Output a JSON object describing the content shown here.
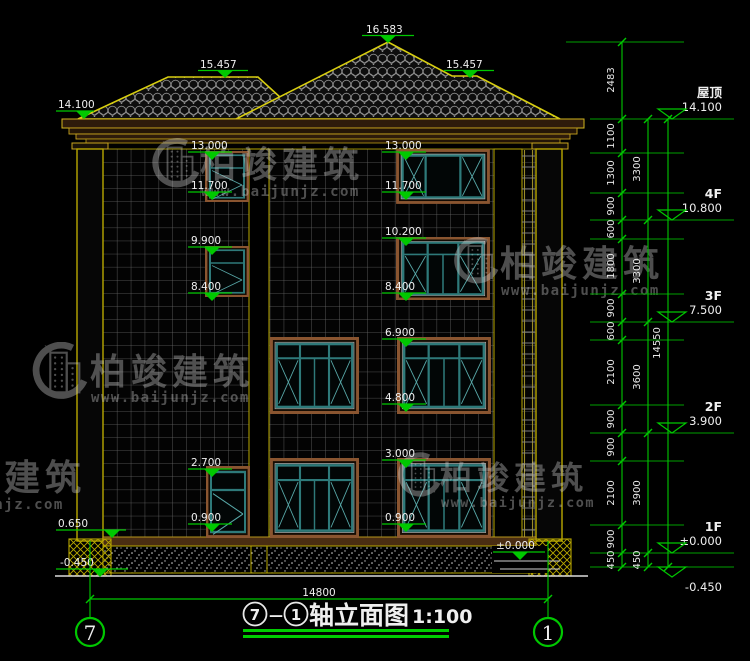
{
  "title": {
    "from": "7",
    "separator": "—",
    "to": "1",
    "text": "轴立面图",
    "scale": "1:100"
  },
  "axes": {
    "left": "7",
    "right": "1"
  },
  "dims": {
    "width": "14800",
    "total": "14550",
    "inner": [
      "2483",
      "1100",
      "1300",
      "900",
      "600",
      "1800",
      "900",
      "600",
      "2100",
      "900",
      "900",
      "2100",
      "900",
      "450"
    ],
    "mid": [
      "3300",
      "3300",
      "3600",
      "3900",
      "450"
    ]
  },
  "marks": {
    "roof_peak": "16.583",
    "roof_ridge_left": "15.457",
    "roof_ridge_right": "15.457",
    "eave_left": "14.100",
    "plinth_left": "0.650",
    "ground_left": "-0.450",
    "left_bay": [
      "13.000",
      "11.700",
      "9.900",
      "8.400",
      "2.700",
      "0.900"
    ],
    "mid_bay": [
      "13.000",
      "11.700",
      "10.200",
      "8.400",
      "6.900",
      "4.800",
      "3.000",
      "0.900"
    ],
    "entry": "±0.000"
  },
  "floors": [
    {
      "name": "屋顶",
      "elev": "14.100"
    },
    {
      "name": "4F",
      "elev": "10.800"
    },
    {
      "name": "3F",
      "elev": "7.500"
    },
    {
      "name": "2F",
      "elev": "3.900"
    },
    {
      "name": "1F",
      "elev": "±0.000"
    },
    {
      "name": "",
      "elev": "-0.450"
    }
  ],
  "watermark": {
    "brand": "柏竣建筑",
    "url": "www.baijunjz.com"
  },
  "colors": {
    "annotation_green": "#00c800",
    "outline_yellow": "#d8ce10",
    "frame_yellow": "#b9a800",
    "window_teal": "#2e7a7a",
    "surround_brown": "#8a5530"
  }
}
